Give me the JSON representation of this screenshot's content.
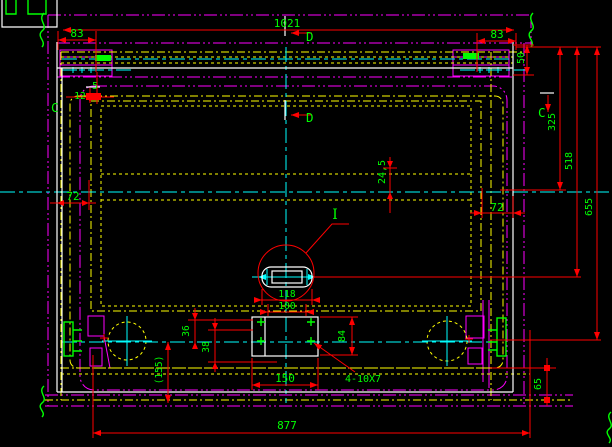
{
  "app": {
    "type": "cad-drawing-view",
    "content": "engineering drawing of hatch/door frame, plan-section view"
  },
  "colors": {
    "background": "#000000",
    "dimension_lines": "#ff0000",
    "dimension_text": "#00ff00",
    "visible_outline": "#ffffff",
    "hidden_lines": "#ffff00",
    "centerlines": "#00ffff",
    "phantom_lines": "#ff00ff"
  },
  "drawing": {
    "sections": {
      "c": "C",
      "d": "D"
    },
    "detail_label": "I",
    "dimensions": {
      "total_width": "1021",
      "left_offset_83": "83",
      "right_offset_83": "83",
      "top_rail_50": "50",
      "right_325": "325",
      "right_518": "518",
      "right_655": "655",
      "corner_5": "5",
      "corner_12": "12",
      "frame_left_72": "72",
      "frame_right_72": "72",
      "center_24_5": "24,5",
      "slot_118": "118",
      "slot_100": "100",
      "plate_84": "84",
      "plate_150": "150",
      "holes_note": "4-10X7",
      "dim_36": "36",
      "dim_38": "38",
      "dim_155": "(155)",
      "dim_65": "65",
      "base_877": "877"
    }
  }
}
